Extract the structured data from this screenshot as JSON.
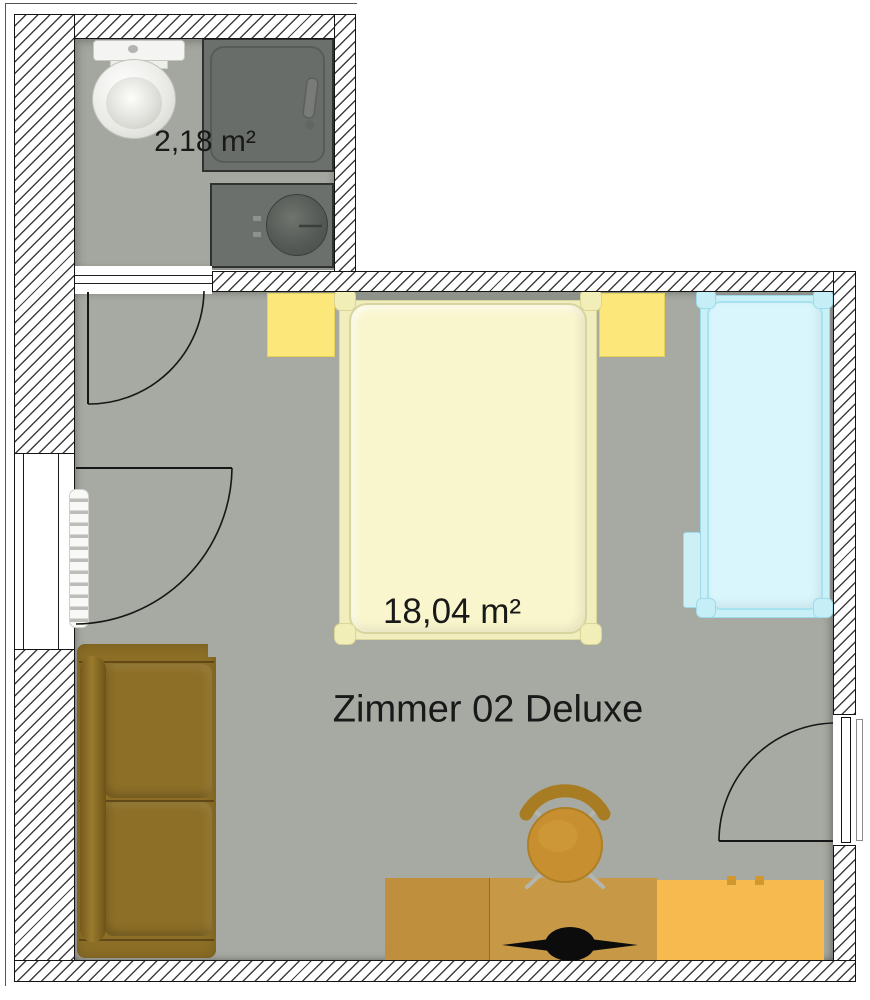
{
  "labels": {
    "bathroom_area": "2,18 m²",
    "room_area": "18,04 m²",
    "room_name": "Zimmer 02 Deluxe"
  },
  "rooms": [
    {
      "name": "bathroom",
      "area_label": "2,18 m²"
    },
    {
      "name": "bedroom",
      "area_label": "18,04 m²",
      "title": "Zimmer 02 Deluxe"
    }
  ],
  "fixtures": [
    "toilet",
    "shower",
    "sink",
    "radiator"
  ],
  "furniture": [
    "double-bed",
    "nightstand-left",
    "nightstand-right",
    "single-bed",
    "bedside-table",
    "sofa",
    "desk",
    "tv",
    "office-chair",
    "dresser"
  ],
  "openings": [
    "bathroom-door",
    "balcony-door-window",
    "entry-door"
  ],
  "colors": {
    "floor": "#a7aaa2",
    "bathroom_floor": "#a4a79f",
    "wall_line": "#141414",
    "double_bed_mattress": "#f9f6ce",
    "bed_frame": "#f1eebd",
    "nightstand": "#fce87a",
    "single_bed_mattress": "#d9f6fc",
    "single_bed_frame": "#c9eff7",
    "headboard": "#8f928b",
    "sofa": "#8c6e26",
    "desk": "#c79947",
    "dresser": "#f6ba4e",
    "chair": "#c78f2f",
    "fixture_dark": "#6c706c",
    "tv": "#0c0c0c"
  }
}
